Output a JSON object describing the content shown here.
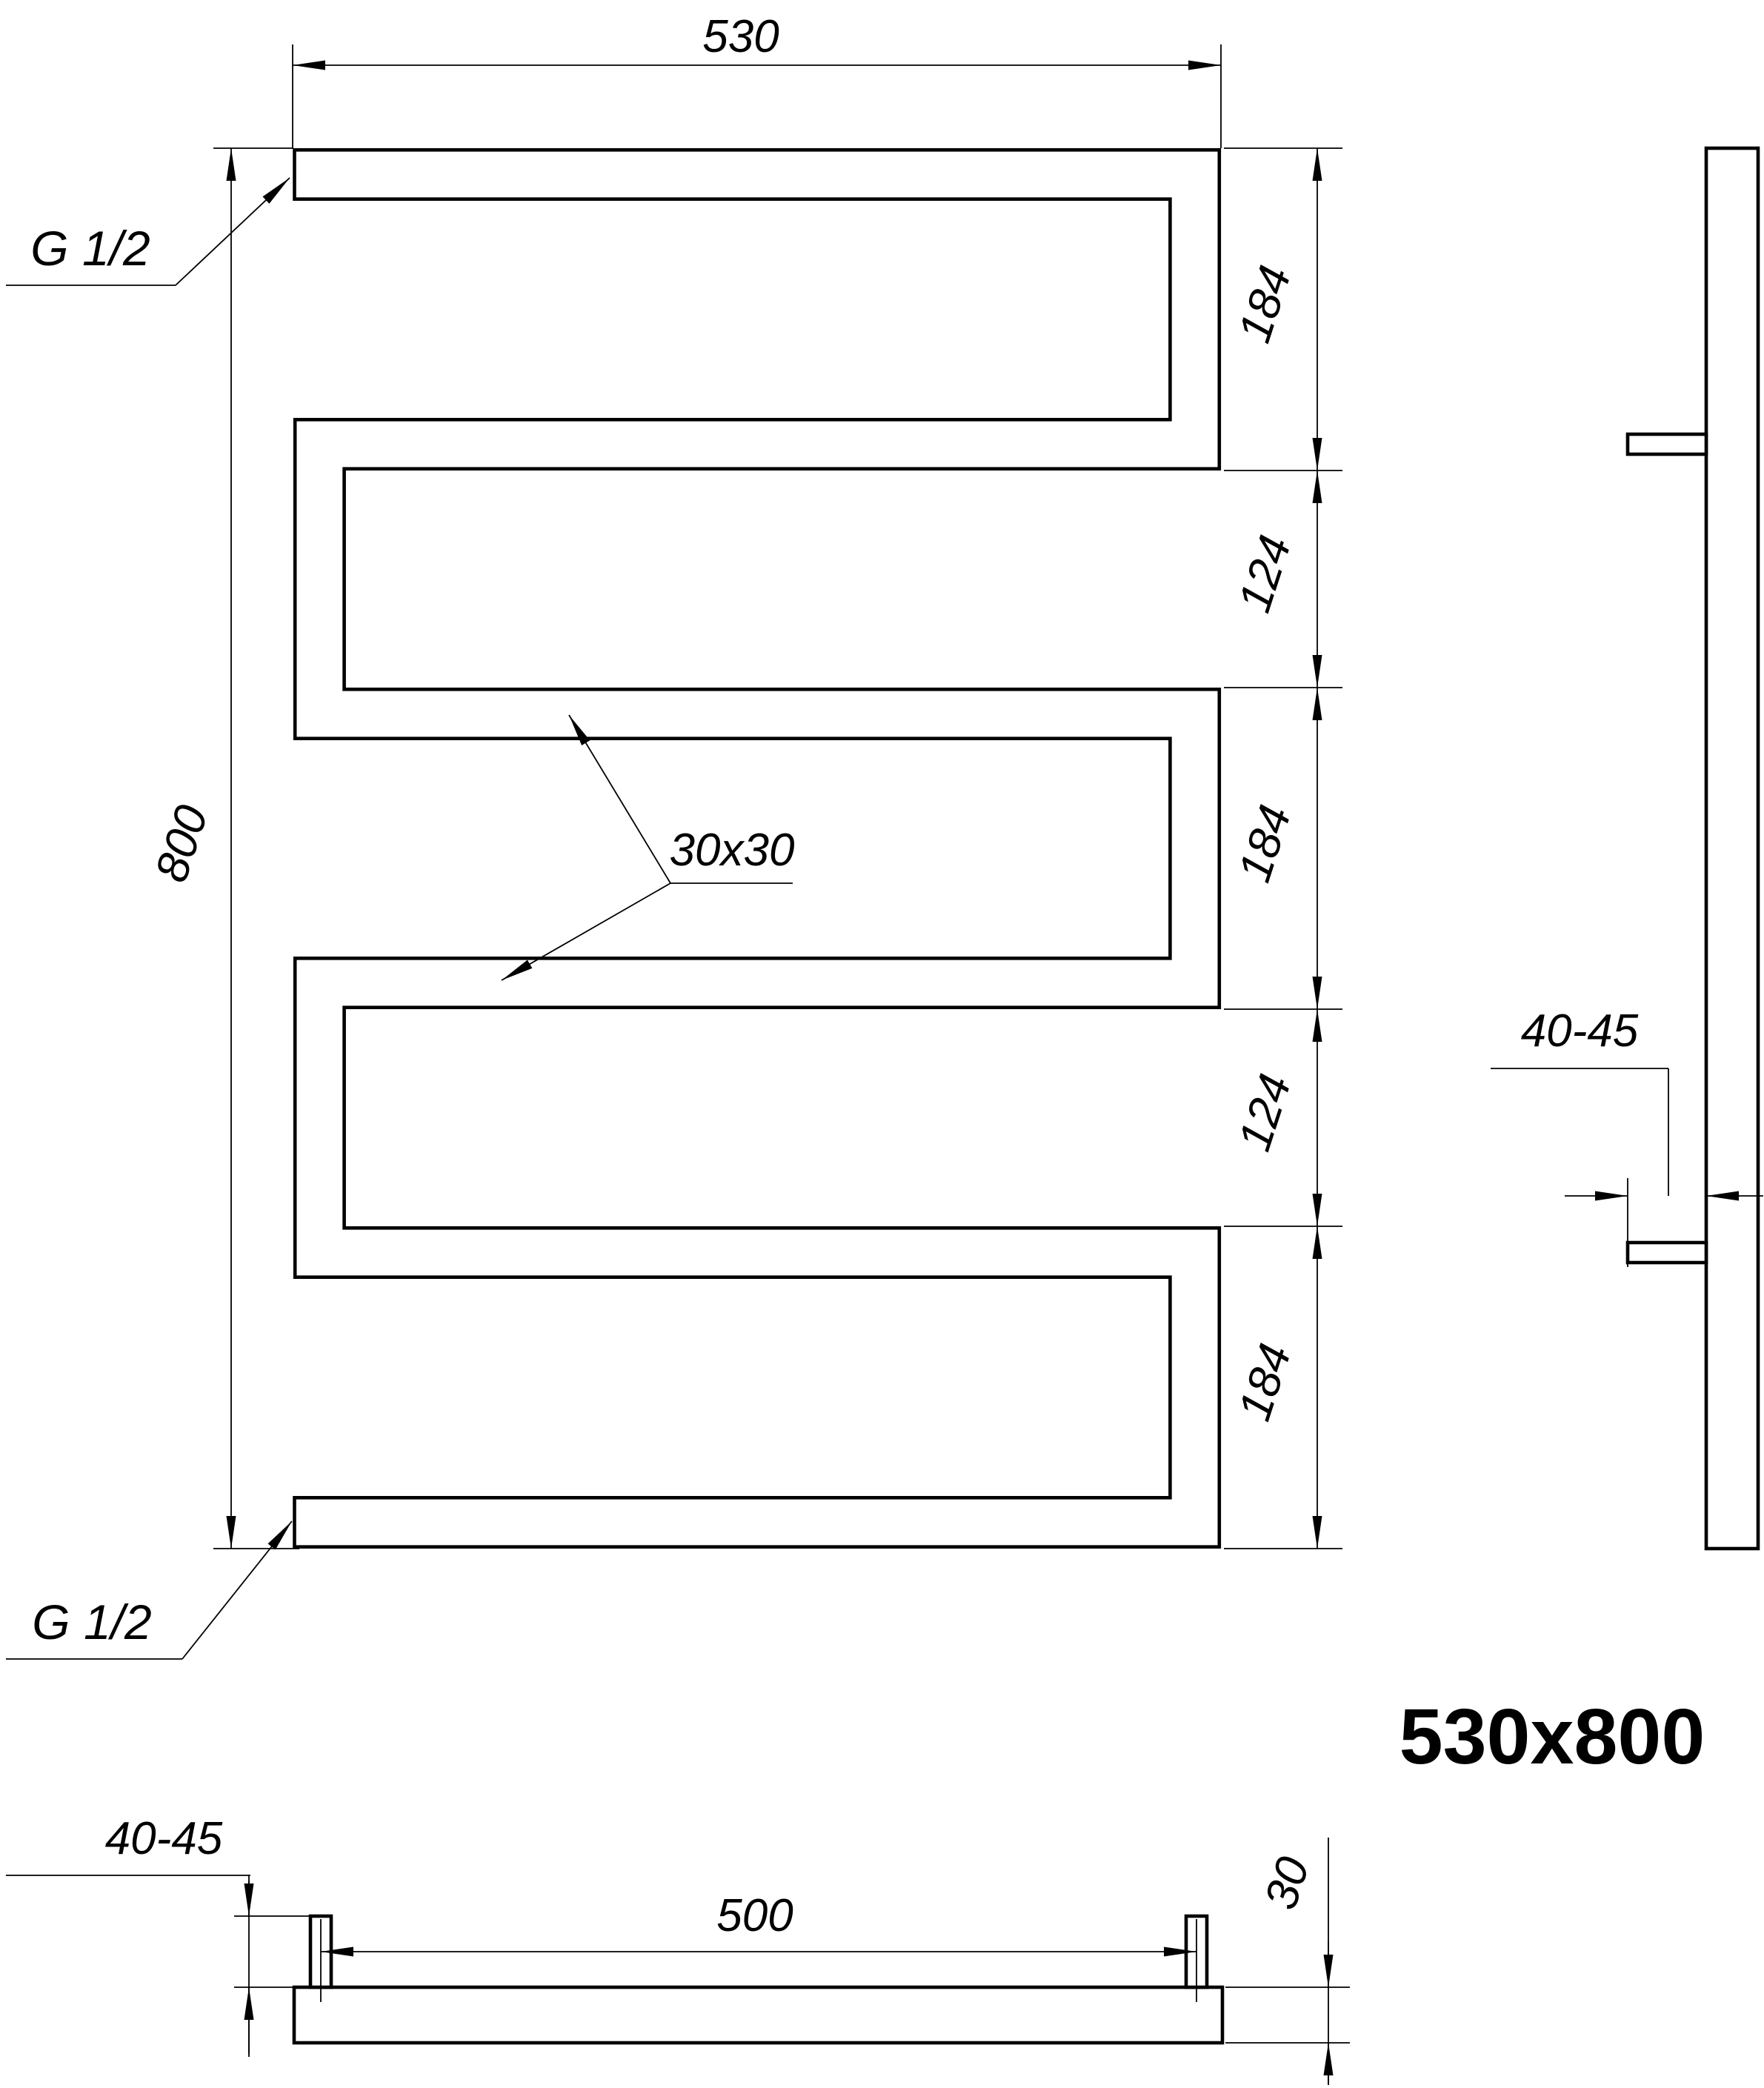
{
  "title": {
    "size_label": "530x800"
  },
  "colors": {
    "line": "#000000",
    "background": "#ffffff"
  },
  "front_view": {
    "width_dim": "530",
    "height_dim": "800",
    "right_dims": [
      "184",
      "124",
      "184",
      "124",
      "184"
    ],
    "tube_section_label": "30x30",
    "inlet_top_label": "G 1/2",
    "inlet_bottom_label": "G 1/2"
  },
  "side_view": {
    "wall_offset_dim": "40-45"
  },
  "bottom_view": {
    "wall_offset_dim": "40-45",
    "bracket_spacing_dim": "500",
    "tube_depth_dim": "30"
  }
}
